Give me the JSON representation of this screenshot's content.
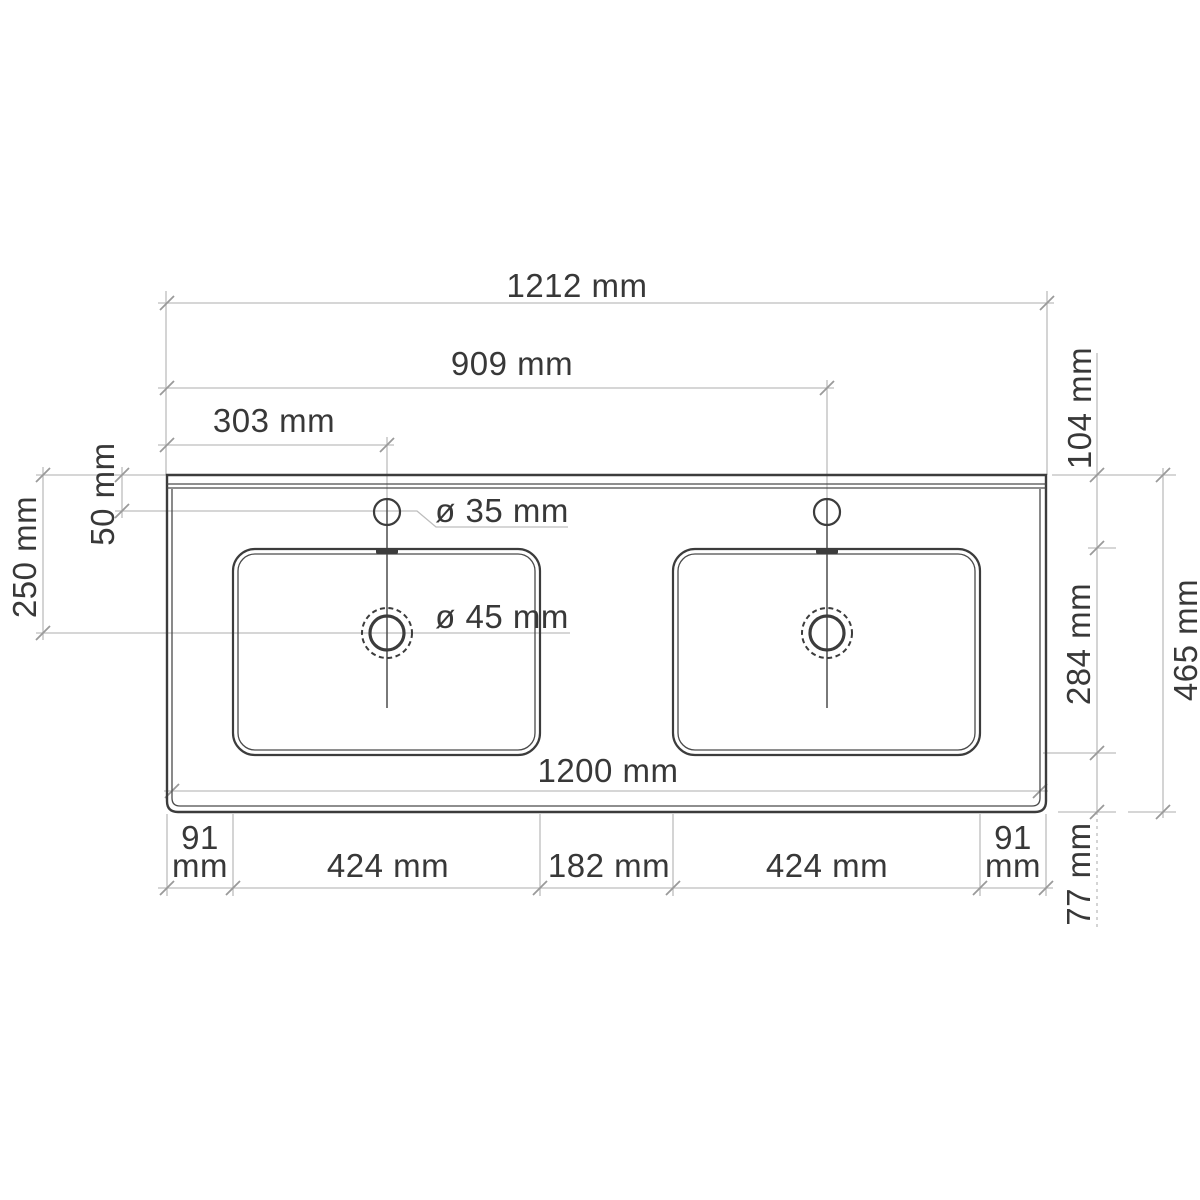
{
  "drawing": {
    "subject": "Double washbasin countertop - dimensioned plan view",
    "unit": "mm",
    "colors": {
      "background": "#ffffff",
      "object_line": "#3c3c3c",
      "dimension_line": "#bdbdbd",
      "label_text": "#383838"
    },
    "dimensions": {
      "overall_width": "1212 mm",
      "left_edge_to_right_faucet": "909 mm",
      "left_edge_to_left_faucet": "303 mm",
      "faucet_hole_diameter": "ø 35 mm",
      "drain_hole_diameter": "ø 45 mm",
      "back_edge_to_faucet_center": "50 mm",
      "back_edge_to_drain_center": "250 mm",
      "back_edge_to_basin": "104 mm",
      "basin_front_to_back": "284 mm",
      "overall_depth": "465 mm",
      "inner_width": "1200 mm",
      "left_margin_value": "91",
      "left_margin_unit": "mm",
      "left_basin_width": "424 mm",
      "basin_gap": "182 mm",
      "right_basin_width": "424 mm",
      "right_margin_value": "91",
      "right_margin_unit": "mm",
      "basin_to_front_edge": "77 mm"
    }
  }
}
